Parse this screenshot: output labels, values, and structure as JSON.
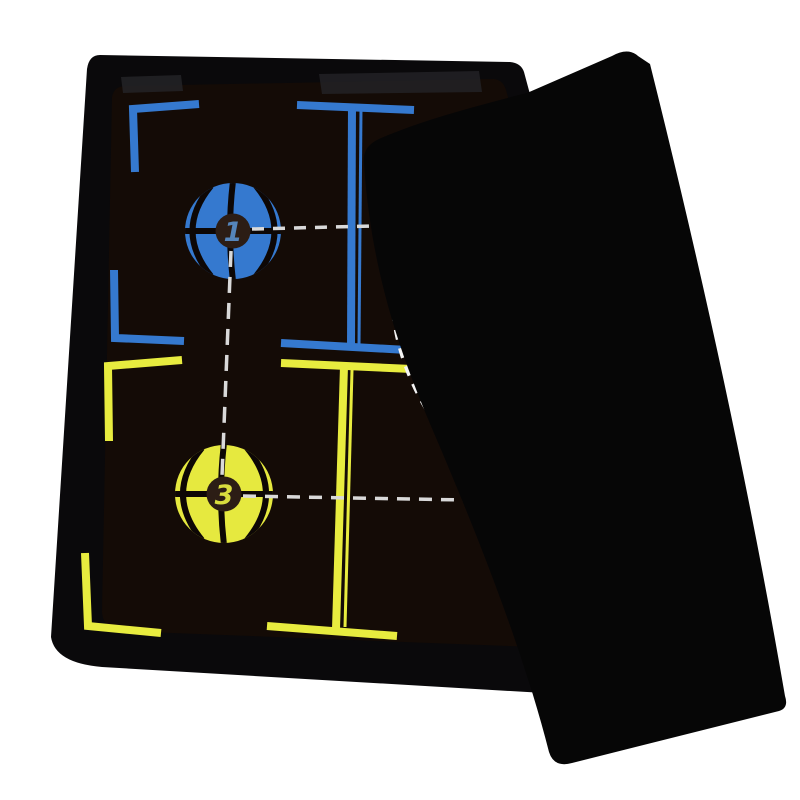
{
  "scene": {
    "type": "product-photo",
    "subject": "Basketball coaching tactic board with fold-over cover sheet",
    "background_color": "#ffffff"
  },
  "board": {
    "frame_color": "#0a090b",
    "surface_color": "#140b06",
    "clip_mark_color": "#232327",
    "cover_color": "#060606"
  },
  "court_lines": {
    "top_half_color": "#3579cf",
    "bottom_half_color": "#e8ec3f",
    "movement_dash_color": "#d9d9d9",
    "arc_dash_color": "#f4f4f4"
  },
  "markers": [
    {
      "number": "1",
      "ball_color": "#3579cf",
      "seam_color": "#0d0705",
      "hub_color": "#2c1d15",
      "number_color": "#5585bb"
    },
    {
      "number": "3",
      "ball_color": "#e6e93f",
      "seam_color": "#0d0705",
      "hub_color": "#2c1d15",
      "number_color": "#d9dd3e"
    }
  ]
}
